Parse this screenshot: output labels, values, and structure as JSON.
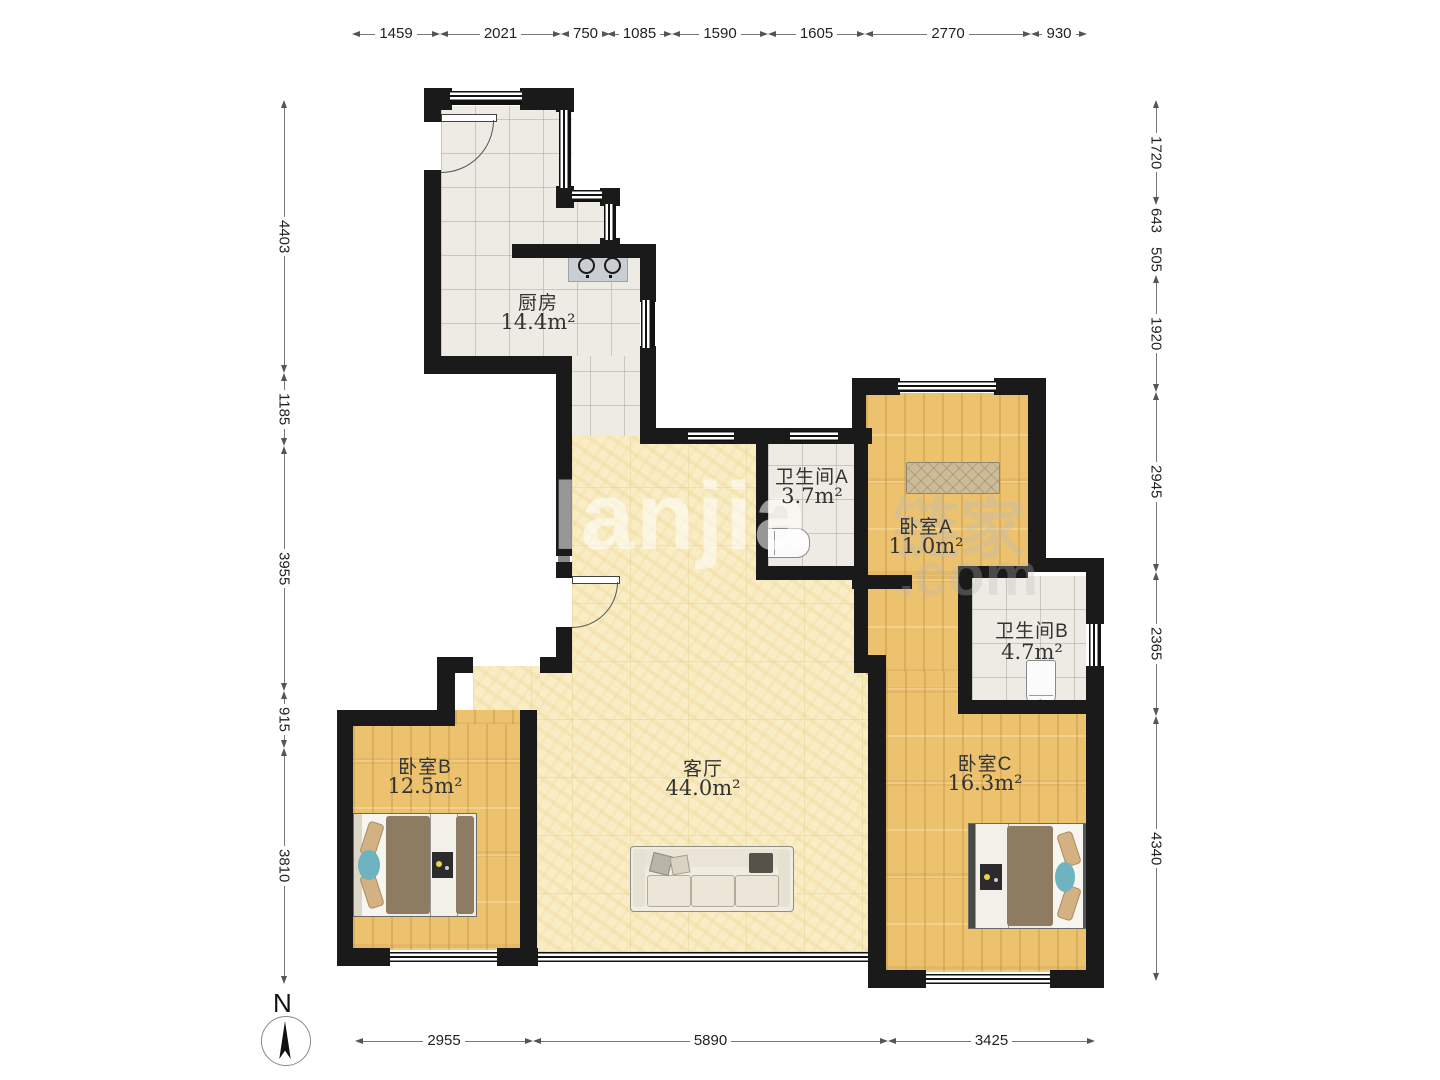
{
  "rooms": [
    {
      "id": "kitchen",
      "name": "厨房",
      "area": "14.4m²"
    },
    {
      "id": "bathroom-a",
      "name": "卫生间A",
      "area": "3.7m²"
    },
    {
      "id": "bedroom-a",
      "name": "卧室A",
      "area": "11.0m²"
    },
    {
      "id": "bathroom-b",
      "name": "卫生间B",
      "area": "4.7m²"
    },
    {
      "id": "bedroom-b",
      "name": "卧室B",
      "area": "12.5m²"
    },
    {
      "id": "living-room",
      "name": "客厅",
      "area": "44.0m²"
    },
    {
      "id": "bedroom-c",
      "name": "卧室C",
      "area": "16.3m²"
    }
  ],
  "dimensions": {
    "top": [
      "1459",
      "2021",
      "750",
      "1085",
      "1590",
      "1605",
      "2770",
      "930"
    ],
    "left": [
      "4403",
      "1185",
      "3955",
      "915",
      "3810"
    ],
    "right": [
      "1720",
      "643",
      "505",
      "1920",
      "2945",
      "2365",
      "4340"
    ],
    "bottom": [
      "2955",
      "5890",
      "3425"
    ]
  },
  "north": {
    "label": "N"
  },
  "watermark": {
    "latin": "lanjia",
    "cjk": "链家",
    "tld": ".com"
  },
  "colors": {
    "wall": "#1a1a1a",
    "wood_floor": "#ecc26f",
    "tile_floor": "#edebe4",
    "living_floor": "#f8edc5",
    "duvet": "#8d7b62",
    "teal_cushion": "#6db3c0"
  }
}
